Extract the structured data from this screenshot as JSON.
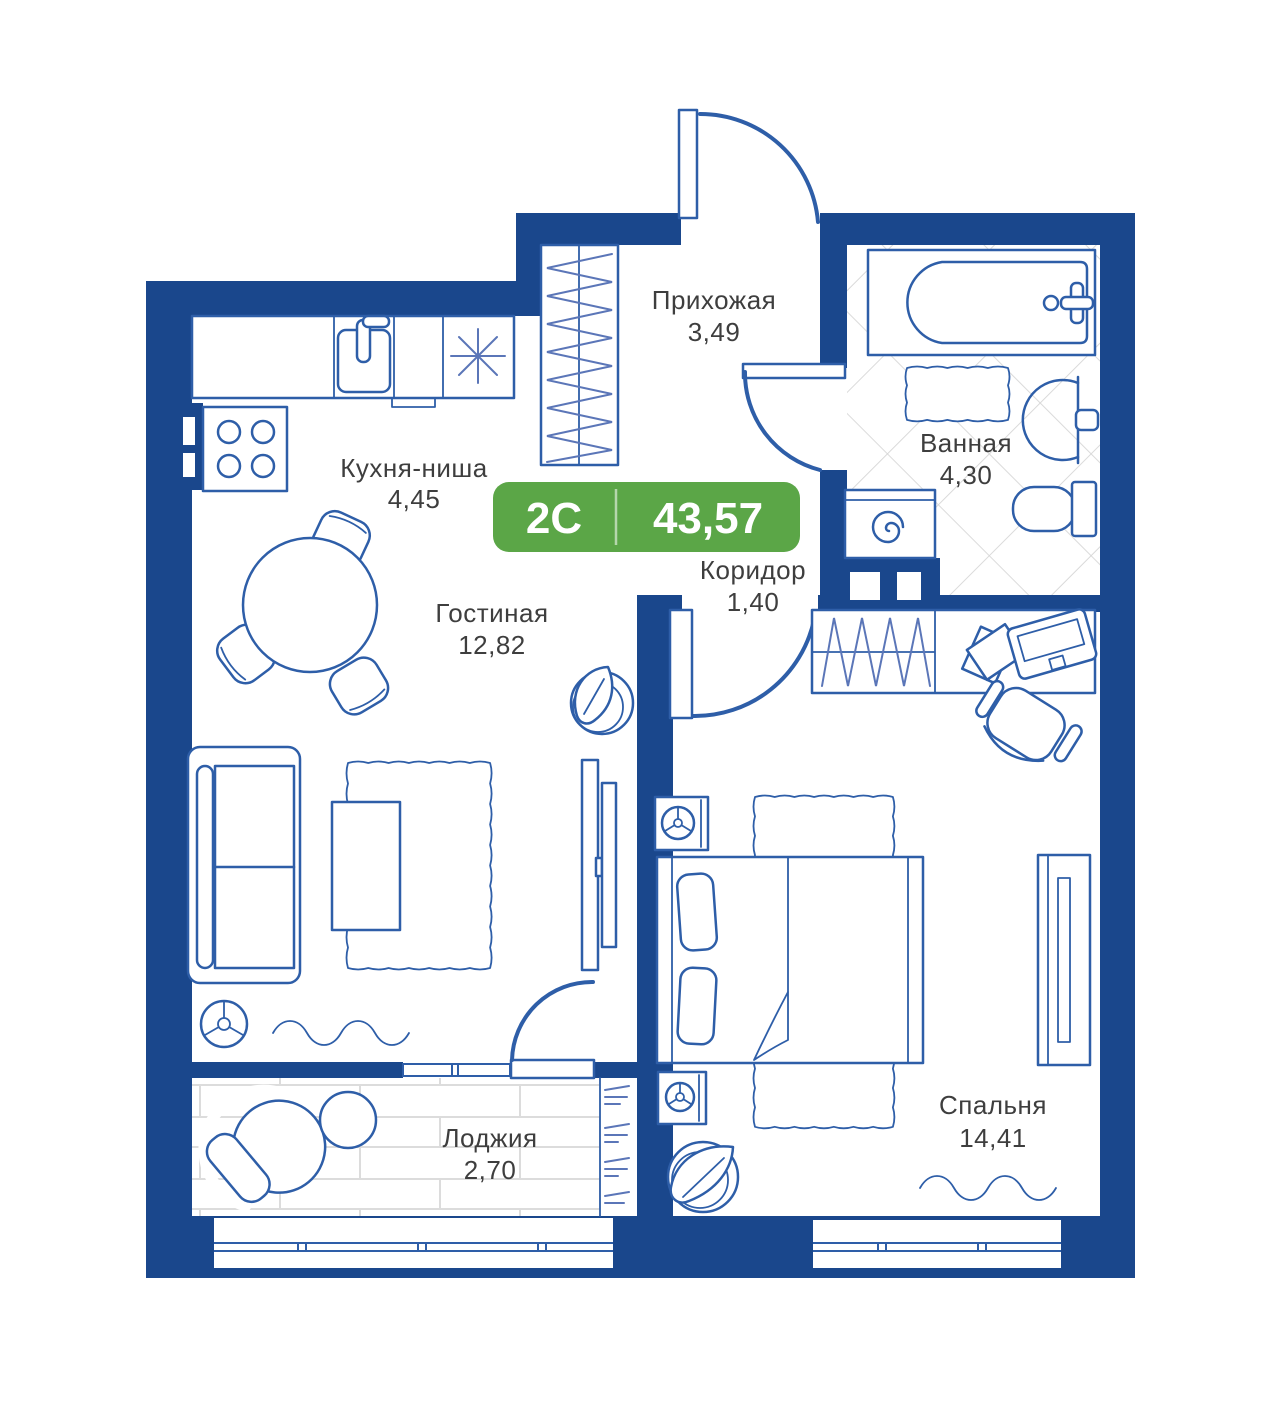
{
  "plan": {
    "badge": {
      "type_label": "2С",
      "area_value": "43,57"
    },
    "rooms": [
      {
        "name": "Прихожая",
        "area": "3,49"
      },
      {
        "name": "Ванная",
        "area": "4,30"
      },
      {
        "name": "Кухня-ниша",
        "area": "4,45"
      },
      {
        "name": "Коридор",
        "area": "1,40"
      },
      {
        "name": "Гостиная",
        "area": "12,82"
      },
      {
        "name": "Спальня",
        "area": "14,41"
      },
      {
        "name": "Лоджия",
        "area": "2,70"
      }
    ],
    "colors": {
      "wall": "#1a478c",
      "furniture": "#2e5ea8",
      "hatch": "#5b76b8",
      "tile": "#d6d6d6",
      "plank": "#dcdcdc",
      "badge_green": "#5ba647",
      "label_text": "#3e3e3e"
    }
  }
}
